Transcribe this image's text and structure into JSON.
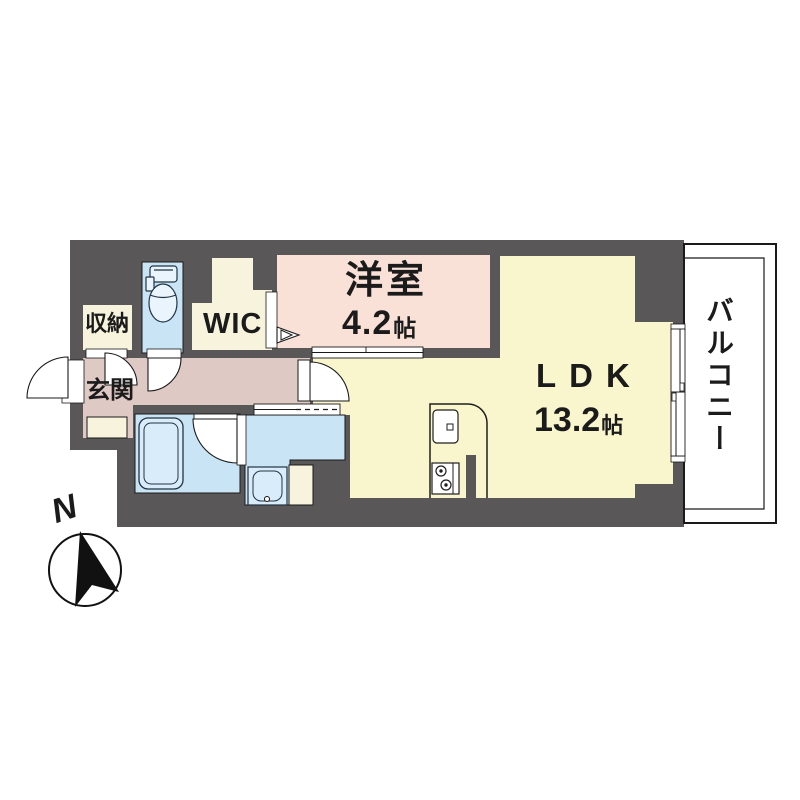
{
  "floorplan": {
    "type": "apartment-floor-plan",
    "rooms": [
      {
        "id": "western-room",
        "label": "洋室",
        "size_value": "4.2",
        "size_unit": "帖"
      },
      {
        "id": "ldk",
        "label": "LDK",
        "size_value": "13.2",
        "size_unit": "帖"
      },
      {
        "id": "wic",
        "label": "WIC"
      },
      {
        "id": "storage",
        "label": "収納"
      },
      {
        "id": "entrance",
        "label": "玄関"
      },
      {
        "id": "balcony",
        "label": "バルコニー"
      }
    ],
    "compass": {
      "label": "N"
    },
    "fixtures": [
      "toilet-icon",
      "bathtub-icon",
      "washbasin-icon",
      "kitchen-sink-icon",
      "stove-icon",
      "sliding-window-icon",
      "door-swing-icon",
      "wic-entry-chevron-icon"
    ],
    "colors": {
      "wall": "#595757",
      "western_room": "#fae1d8",
      "ldk": "#f9f5cd",
      "closet_cream": "#f7f3dc",
      "hall_mauve": "#dfc9c4",
      "wet_area_blue": "#c9e4f4",
      "fixture_fill": "#dcedfa",
      "outline": "#1a1a1a"
    }
  }
}
